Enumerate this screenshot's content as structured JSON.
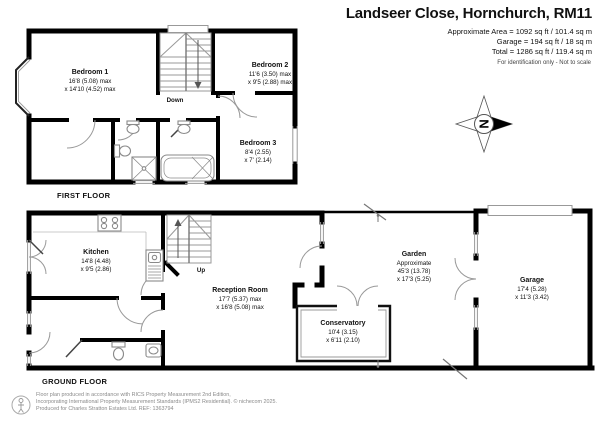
{
  "header": {
    "title": "Landseer Close, Hornchurch, RM11",
    "area_lines": [
      "Approximate Area = 1092 sq ft / 101.4 sq m",
      "Garage = 194 sq ft / 18 sq m",
      "Total = 1286 sq ft / 119.4 sq m"
    ],
    "disclaimer": "For identification only - Not to scale"
  },
  "floors": {
    "first": {
      "label": "FIRST FLOOR",
      "stairs_label": "Down",
      "rooms": [
        {
          "name": "Bedroom 1",
          "dims": [
            "16'8 (5.08) max",
            "x 14'10 (4.52) max"
          ]
        },
        {
          "name": "Bedroom 2",
          "dims": [
            "11'6 (3.50) max",
            "x 9'5 (2.88) max"
          ]
        },
        {
          "name": "Bedroom 3",
          "dims": [
            "8'4 (2.55)",
            "x 7' (2.14)"
          ]
        }
      ]
    },
    "ground": {
      "label": "GROUND FLOOR",
      "stairs_label": "Up",
      "rooms": [
        {
          "name": "Kitchen",
          "dims": [
            "14'8 (4.48)",
            "x 9'5 (2.86)"
          ]
        },
        {
          "name": "Reception Room",
          "dims": [
            "17'7 (5.37) max",
            "x 16'8 (5.08) max"
          ]
        },
        {
          "name": "Conservatory",
          "dims": [
            "10'4 (3.15)",
            "x 6'11 (2.10)"
          ]
        },
        {
          "name": "Garden",
          "dims": [
            "Approximate",
            "45'3 (13.78)",
            "x 17'3 (5.25)"
          ]
        },
        {
          "name": "Garage",
          "dims": [
            "17'4 (5.28)",
            "x 11'3 (3.42)"
          ]
        }
      ]
    }
  },
  "compass": {
    "north": "N"
  },
  "footer": {
    "lines": [
      "Floor plan produced in accordance with RICS Property Measurement 2nd Edition,",
      "Incorporating International Property Measurement Standards (IPMS2 Residential).   © nichecom 2025.",
      "Produced for Charles Stratton Estates Ltd.   REF: 1363794"
    ]
  },
  "colors": {
    "wall": "#000000",
    "fixture": "#8a8a8a",
    "arc": "#999999"
  }
}
